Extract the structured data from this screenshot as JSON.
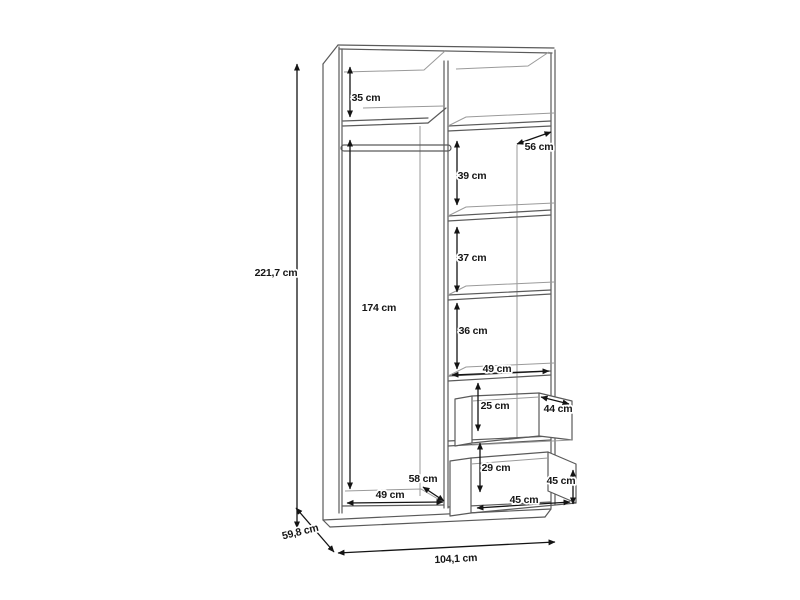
{
  "diagram": {
    "kind": "wardrobe-dimension-drawing",
    "unit": "cm",
    "overall": {
      "height": "221,7 cm",
      "width": "104,1 cm",
      "depth": "59,8 cm"
    },
    "labels": [
      {
        "id": "overall-height",
        "text": "221,7 cm",
        "x": 276,
        "y": 276,
        "rot": 0
      },
      {
        "id": "top-section-height",
        "text": "35 cm",
        "x": 366,
        "y": 101,
        "rot": 0
      },
      {
        "id": "shelf-depth",
        "text": "56 cm",
        "x": 539,
        "y": 150,
        "rot": 0
      },
      {
        "id": "shelf-gap-1",
        "text": "39 cm",
        "x": 472,
        "y": 179,
        "rot": 0
      },
      {
        "id": "shelf-gap-2",
        "text": "37 cm",
        "x": 472,
        "y": 261,
        "rot": 0
      },
      {
        "id": "shelf-gap-3",
        "text": "36 cm",
        "x": 473,
        "y": 334,
        "rot": 0
      },
      {
        "id": "hanging-height",
        "text": "174 cm",
        "x": 379,
        "y": 311,
        "rot": 0
      },
      {
        "id": "shelf-width",
        "text": "49 cm",
        "x": 497,
        "y": 372,
        "rot": 0
      },
      {
        "id": "drawer1-height",
        "text": "25 cm",
        "x": 495,
        "y": 409,
        "rot": 0
      },
      {
        "id": "drawer1-depth",
        "text": "44 cm",
        "x": 558,
        "y": 412,
        "rot": 0
      },
      {
        "id": "drawer2-height",
        "text": "29 cm",
        "x": 496,
        "y": 471,
        "rot": 0
      },
      {
        "id": "drawer2-side-height",
        "text": "45 cm",
        "x": 561,
        "y": 484,
        "rot": 0
      },
      {
        "id": "drawer2-width",
        "text": "45 cm",
        "x": 524,
        "y": 503,
        "rot": 0
      },
      {
        "id": "left-depth",
        "text": "58 cm",
        "x": 423,
        "y": 482,
        "rot": 0
      },
      {
        "id": "left-width",
        "text": "49 cm",
        "x": 390,
        "y": 498,
        "rot": 0
      },
      {
        "id": "overall-depth",
        "text": "59,8 cm",
        "x": 301,
        "y": 535,
        "rot": -14
      },
      {
        "id": "overall-width",
        "text": "104,1 cm",
        "x": 456,
        "y": 562,
        "rot": -3
      }
    ],
    "arrows": [
      {
        "id": "overall-height",
        "x1": 297,
        "y1": 64,
        "x2": 297,
        "y2": 528
      },
      {
        "id": "top-section-height",
        "x1": 350,
        "y1": 67,
        "x2": 350,
        "y2": 117
      },
      {
        "id": "hanging-height",
        "x1": 350,
        "y1": 140,
        "x2": 350,
        "y2": 489
      },
      {
        "id": "shelf-gap-1",
        "x1": 457,
        "y1": 141,
        "x2": 457,
        "y2": 205
      },
      {
        "id": "shelf-gap-2",
        "x1": 457,
        "y1": 227,
        "x2": 457,
        "y2": 292
      },
      {
        "id": "shelf-gap-3",
        "x1": 457,
        "y1": 303,
        "x2": 457,
        "y2": 369
      },
      {
        "id": "shelf-width",
        "x1": 452,
        "y1": 375,
        "x2": 549,
        "y2": 371
      },
      {
        "id": "drawer1-height",
        "x1": 478,
        "y1": 383,
        "x2": 478,
        "y2": 431
      },
      {
        "id": "drawer2-height",
        "x1": 480,
        "y1": 443,
        "x2": 480,
        "y2": 492
      },
      {
        "id": "drawer2-side-height",
        "x1": 573,
        "y1": 470,
        "x2": 573,
        "y2": 504
      },
      {
        "id": "drawer2-width",
        "x1": 477,
        "y1": 508,
        "x2": 570,
        "y2": 502
      },
      {
        "id": "left-width",
        "x1": 347,
        "y1": 503,
        "x2": 443,
        "y2": 502
      },
      {
        "id": "left-depth",
        "x1": 423,
        "y1": 487,
        "x2": 444,
        "y2": 501
      },
      {
        "id": "shelf-depth",
        "x1": 517,
        "y1": 144,
        "x2": 551,
        "y2": 132
      },
      {
        "id": "drawer1-depth",
        "x1": 541,
        "y1": 397,
        "x2": 569,
        "y2": 404
      },
      {
        "id": "overall-depth",
        "x1": 296,
        "y1": 508,
        "x2": 334,
        "y2": 552
      },
      {
        "id": "overall-width",
        "x1": 338,
        "y1": 553,
        "x2": 555,
        "y2": 542
      }
    ]
  }
}
